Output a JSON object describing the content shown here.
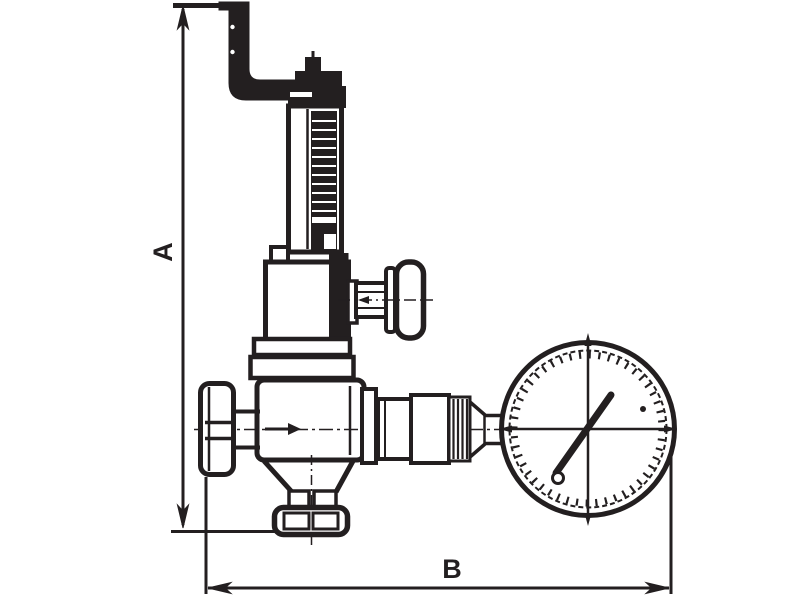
{
  "drawing": {
    "type": "technical line drawing",
    "subject": "relief valve with exhaust pipe, adjustment handles and pressure gauge",
    "background_color": "#ffffff",
    "line_color": "#231f20",
    "dimension_labels": {
      "vertical": "A",
      "horizontal": "B"
    },
    "components": [
      "exhaust-pipe",
      "top-cap",
      "spring-housing",
      "bonnet",
      "side-handle",
      "inlet-handle",
      "valve-body",
      "outlet-union",
      "gauge-stem",
      "pressure-gauge",
      "gauge-needle",
      "bottom-flange",
      "dimension-line-a",
      "dimension-line-b"
    ]
  }
}
